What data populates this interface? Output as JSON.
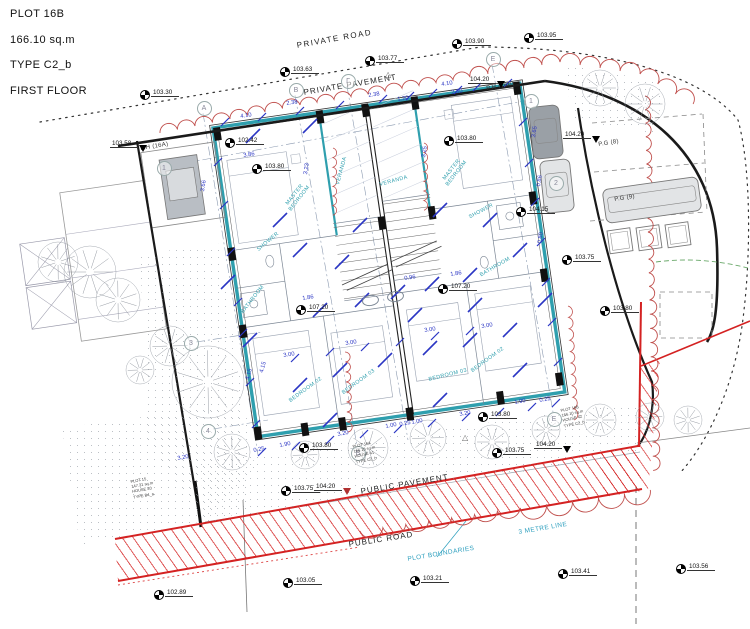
{
  "title_block": {
    "lines": [
      "PLOT 16B",
      "166.10 sq.m",
      "TYPE C2_b",
      "FIRST FLOOR"
    ]
  },
  "colors": {
    "wall_teal": "#2f9fae",
    "dimension_blue": "#2b36c4",
    "boundary_red": "#d42222",
    "cloud_red": "#c0504d",
    "teal_text": "#2d9fbe",
    "line_black": "#1a1a1a"
  },
  "area_labels": [
    {
      "t": "PRIVATE ROAD",
      "x": 296,
      "y": 41,
      "r": -10,
      "s": 8,
      "c": "#222",
      "ls": 1.5
    },
    {
      "t": "PRIVATE PAVEMENT",
      "x": 303,
      "y": 88,
      "r": -9.5,
      "s": 8,
      "c": "#222",
      "ls": 1
    },
    {
      "t": "PUBLIC PAVEMENT",
      "x": 360,
      "y": 487,
      "r": -9.5,
      "s": 8,
      "c": "#222",
      "ls": 1
    },
    {
      "t": "PUBLIC ROAD",
      "x": 348,
      "y": 540,
      "r": -9,
      "s": 8,
      "c": "#222",
      "ls": 1
    },
    {
      "t": "3 METRE LINE",
      "x": 518,
      "y": 529,
      "r": -9.5,
      "s": 6.5,
      "c": "#2d9fbe",
      "ls": 0.4
    },
    {
      "t": "PLOT BOUNDARIES",
      "x": 407,
      "y": 556,
      "r": -9.5,
      "s": 6.5,
      "c": "#2d9fbe",
      "ls": 0.4
    },
    {
      "t": "P.H (16A)",
      "x": 140,
      "y": 146,
      "r": -9,
      "s": 6,
      "c": "#333",
      "ls": 0.3
    },
    {
      "t": "P.H (16B)",
      "x": 486,
      "y": 86,
      "r": -9,
      "s": 6,
      "c": "#333",
      "ls": 0.3
    },
    {
      "t": "P.G (8)",
      "x": 598,
      "y": 142,
      "r": -9,
      "s": 6,
      "c": "#333",
      "ls": 0.3
    },
    {
      "t": "P.G (9)",
      "x": 614,
      "y": 197,
      "r": -9,
      "s": 6,
      "c": "#333",
      "ls": 0.3
    }
  ],
  "levels": [
    {
      "v": "103.30",
      "x": 140,
      "y": 90
    },
    {
      "v": "103.63",
      "x": 280,
      "y": 67
    },
    {
      "v": "103.77",
      "x": 365,
      "y": 56
    },
    {
      "v": "103.90",
      "x": 452,
      "y": 39
    },
    {
      "v": "103.95",
      "x": 524,
      "y": 33
    },
    {
      "v": "102.42",
      "x": 225,
      "y": 138
    },
    {
      "v": "103.80",
      "x": 252,
      "y": 164
    },
    {
      "v": "103.80",
      "x": 444,
      "y": 136
    },
    {
      "v": "104.15",
      "x": 516,
      "y": 207
    },
    {
      "v": "103.75",
      "x": 562,
      "y": 255
    },
    {
      "v": "103.80",
      "x": 600,
      "y": 306
    },
    {
      "v": "107.20",
      "x": 296,
      "y": 305
    },
    {
      "v": "107.20",
      "x": 438,
      "y": 284
    },
    {
      "v": "103.80",
      "x": 299,
      "y": 443
    },
    {
      "v": "103.80",
      "x": 478,
      "y": 412
    },
    {
      "v": "103.75",
      "x": 281,
      "y": 486
    },
    {
      "v": "103.75",
      "x": 492,
      "y": 448
    },
    {
      "v": "103.21",
      "x": 410,
      "y": 576
    },
    {
      "v": "103.41",
      "x": 558,
      "y": 569
    },
    {
      "v": "103.05",
      "x": 283,
      "y": 578
    },
    {
      "v": "102.89",
      "x": 154,
      "y": 590
    },
    {
      "v": "103.56",
      "x": 676,
      "y": 564
    }
  ],
  "tri_levels": [
    {
      "v": "103.58",
      "x": 110,
      "y": 142,
      "c": "#000"
    },
    {
      "v": "104.20",
      "x": 468,
      "y": 78,
      "c": "#000"
    },
    {
      "v": "104.20",
      "x": 563,
      "y": 133,
      "c": "#000"
    },
    {
      "v": "104.20",
      "x": 314,
      "y": 485,
      "c": "#b03030"
    },
    {
      "v": "104.20",
      "x": 534,
      "y": 443,
      "c": "#000"
    }
  ],
  "dims": [
    {
      "v": "4.10",
      "x": 240,
      "y": 114,
      "r": -9
    },
    {
      "v": "2.38",
      "x": 286,
      "y": 101,
      "r": -9
    },
    {
      "v": "2.38",
      "x": 368,
      "y": 93,
      "r": -9
    },
    {
      "v": "1.20",
      "x": 397,
      "y": 97,
      "r": -9
    },
    {
      "v": "4.10",
      "x": 441,
      "y": 82,
      "r": -9
    },
    {
      "v": "2.50",
      "x": 451,
      "y": 90,
      "r": -9
    },
    {
      "v": "3.86",
      "x": 243,
      "y": 153,
      "r": -9
    },
    {
      "v": "3.66",
      "x": 200,
      "y": 191,
      "r": -81
    },
    {
      "v": "3.23",
      "x": 303,
      "y": 174,
      "r": -81
    },
    {
      "v": "3.25",
      "x": 421,
      "y": 157,
      "r": -81
    },
    {
      "v": "3.65",
      "x": 531,
      "y": 137,
      "r": -81
    },
    {
      "v": "0.86",
      "x": 536,
      "y": 186,
      "r": -81
    },
    {
      "v": "0.80",
      "x": 537,
      "y": 243,
      "r": -81
    },
    {
      "v": "1.86",
      "x": 302,
      "y": 296,
      "r": -9
    },
    {
      "v": "0.96",
      "x": 404,
      "y": 276,
      "r": -9
    },
    {
      "v": "1.86",
      "x": 450,
      "y": 272,
      "r": -9
    },
    {
      "v": "3.00",
      "x": 283,
      "y": 353,
      "r": -9
    },
    {
      "v": "3.00",
      "x": 345,
      "y": 341,
      "r": -9
    },
    {
      "v": "3.00",
      "x": 424,
      "y": 328,
      "r": -9
    },
    {
      "v": "3.00",
      "x": 481,
      "y": 324,
      "r": -9
    },
    {
      "v": "4.15",
      "x": 245,
      "y": 379,
      "r": -75
    },
    {
      "v": "4.15",
      "x": 259,
      "y": 372,
      "r": -75
    },
    {
      "v": "3.20",
      "x": 177,
      "y": 456,
      "r": -10
    },
    {
      "v": "0.25",
      "x": 253,
      "y": 448,
      "r": -10
    },
    {
      "v": "1.90",
      "x": 279,
      "y": 443,
      "r": -10
    },
    {
      "v": "3.20",
      "x": 337,
      "y": 432,
      "r": -10
    },
    {
      "v": "1.00",
      "x": 385,
      "y": 424,
      "r": -10
    },
    {
      "v": "0.25",
      "x": 399,
      "y": 422,
      "r": -10
    },
    {
      "v": "1.00",
      "x": 411,
      "y": 420,
      "r": -10
    },
    {
      "v": "3.20",
      "x": 459,
      "y": 412,
      "r": -10
    },
    {
      "v": "1.90",
      "x": 514,
      "y": 400,
      "r": -10
    },
    {
      "v": "0.25",
      "x": 539,
      "y": 398,
      "r": -10
    }
  ],
  "rooms": [
    {
      "t": "MASTER\nBEDROOM",
      "x": 283,
      "y": 205,
      "r": -52
    },
    {
      "t": "MASTER\nBEDROOM",
      "x": 440,
      "y": 180,
      "r": -52
    },
    {
      "t": "VERANDA",
      "x": 335,
      "y": 184,
      "r": -75
    },
    {
      "t": "VERANDA",
      "x": 379,
      "y": 182,
      "r": -15
    },
    {
      "t": "SHOWER",
      "x": 256,
      "y": 248,
      "r": -40
    },
    {
      "t": "SHOWER",
      "x": 468,
      "y": 215,
      "r": -28
    },
    {
      "t": "BATHROOM",
      "x": 240,
      "y": 311,
      "r": -52
    },
    {
      "t": "BATHROOM",
      "x": 479,
      "y": 273,
      "r": -30
    },
    {
      "t": "BEDROOM 02",
      "x": 288,
      "y": 399,
      "r": -36
    },
    {
      "t": "BEDROOM 03",
      "x": 341,
      "y": 391,
      "r": -36
    },
    {
      "t": "BEDROOM 03",
      "x": 428,
      "y": 377,
      "r": -14
    },
    {
      "t": "BEDROOM 02",
      "x": 470,
      "y": 369,
      "r": -36
    }
  ],
  "bubbles": [
    {
      "t": "A",
      "x": 203,
      "y": 107
    },
    {
      "t": "B",
      "x": 295,
      "y": 89
    },
    {
      "t": "Γ",
      "x": 347,
      "y": 80
    },
    {
      "t": "E",
      "x": 492,
      "y": 58
    },
    {
      "t": "1",
      "x": 163,
      "y": 167
    },
    {
      "t": "1",
      "x": 530,
      "y": 100
    },
    {
      "t": "2",
      "x": 555,
      "y": 182
    },
    {
      "t": "3",
      "x": 190,
      "y": 342
    },
    {
      "t": "4",
      "x": 207,
      "y": 430
    },
    {
      "t": "B",
      "x": 357,
      "y": 452
    },
    {
      "t": "E",
      "x": 553,
      "y": 418
    }
  ],
  "triangle_symbols": [
    {
      "x": 385,
      "y": 70
    },
    {
      "x": 462,
      "y": 433
    }
  ],
  "plot_blocks": [
    {
      "x": 352,
      "y": 444,
      "r": -12,
      "lines": [
        "PLOT 16A",
        "166.10 sq.m",
        "HOUSE 41",
        "TYPE C2_b"
      ]
    },
    {
      "x": 560,
      "y": 408,
      "r": -12,
      "lines": [
        "PLOT 16B",
        "166.10 sq.m",
        "HOUSE 42",
        "TYPE C2_b"
      ]
    },
    {
      "x": 130,
      "y": 479,
      "r": -10,
      "lines": [
        "PLOT 15",
        "147.31 sq.m",
        "HOUSE 40",
        "TYPE B4_a"
      ]
    }
  ]
}
